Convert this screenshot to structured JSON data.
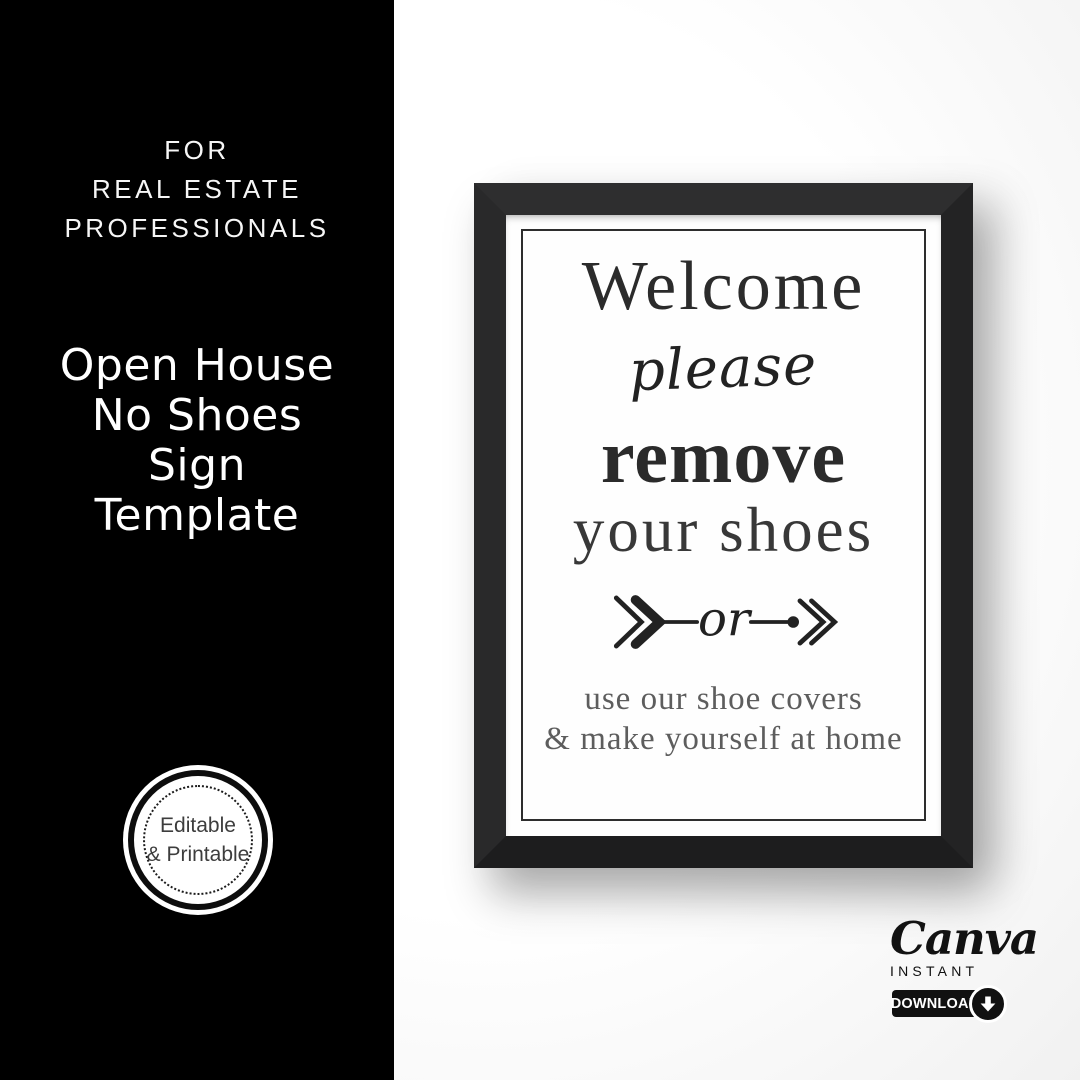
{
  "left_panel": {
    "eyebrow_lines": [
      "FOR",
      "REAL ESTATE",
      "PROFESSIONALS"
    ],
    "title_lines": [
      "Open House",
      "No Shoes",
      "Sign",
      "Template"
    ],
    "badge_lines": [
      "Editable",
      "& Printable"
    ]
  },
  "poster": {
    "heading": "Welcome",
    "script_word": "please",
    "emphasis": "remove",
    "subheading": "your shoes",
    "divider_word": "or",
    "footer_lines": [
      "use our shoe covers",
      "& make yourself at home"
    ]
  },
  "branding": {
    "logo": "Canva",
    "tagline": "INSTANT",
    "button_label": "DOWNLOAD"
  },
  "colors": {
    "panel_bg": "#000000",
    "wall_bg": "#ffffff",
    "frame": "#262626",
    "poster_text": "#2b2b2b",
    "poster_footer_text": "#5d5d5d",
    "badge_text": "#3d3d3d",
    "brand_color": "#111111"
  }
}
